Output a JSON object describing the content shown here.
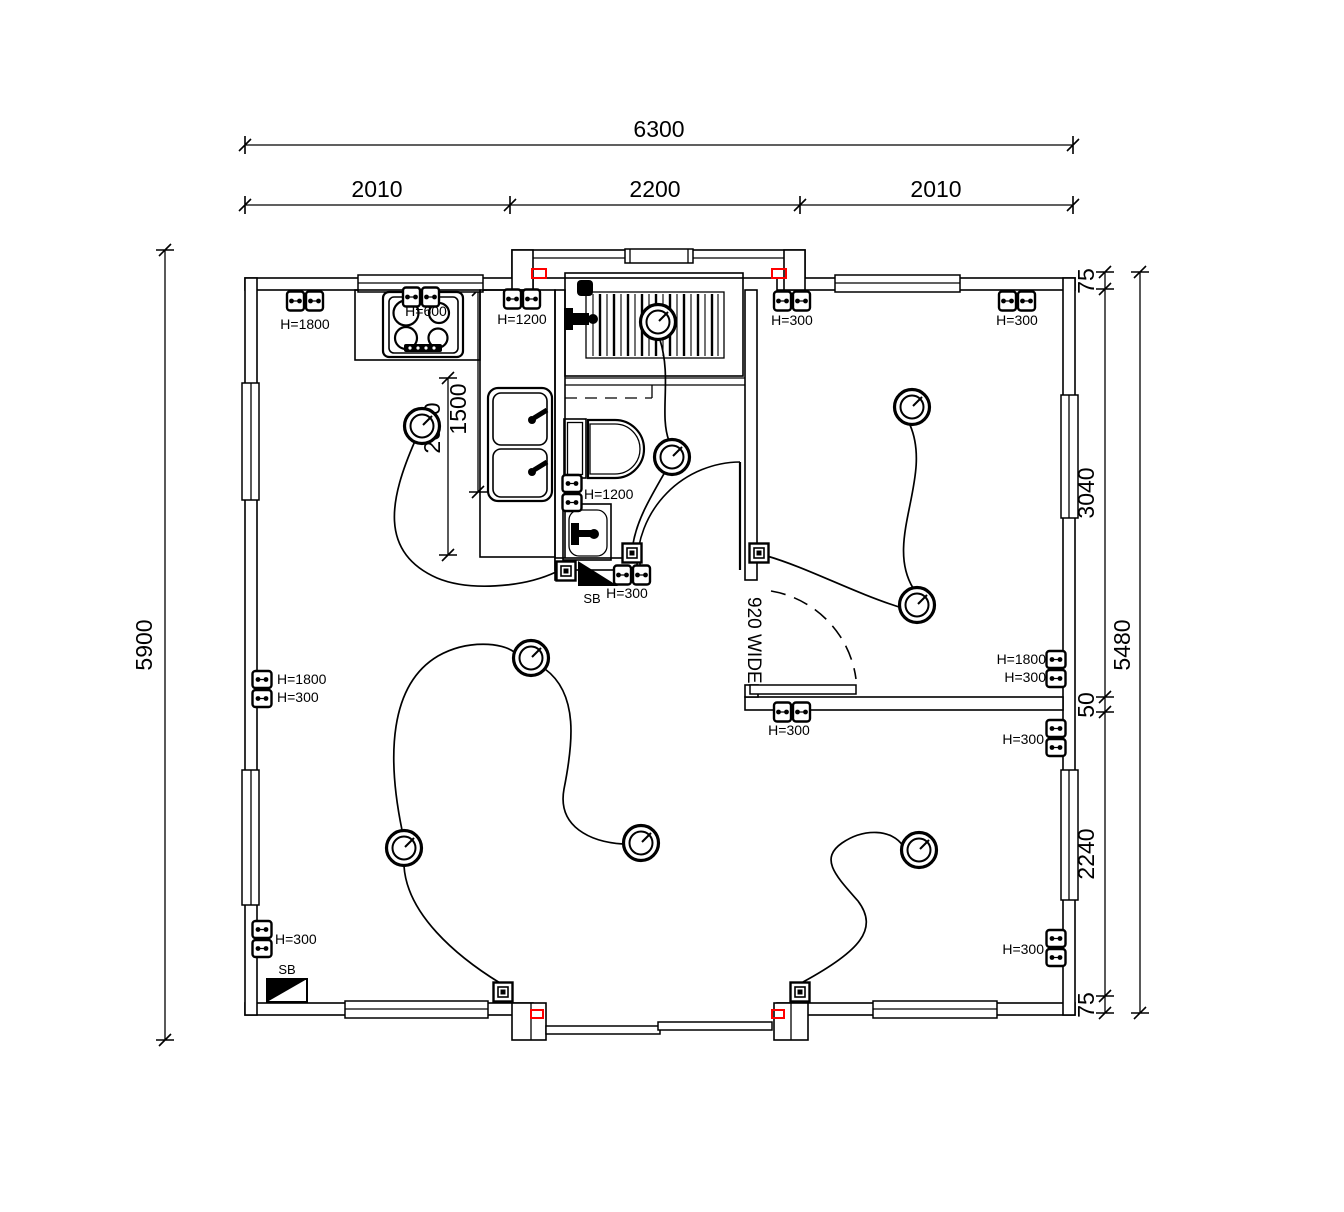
{
  "drawing": {
    "kind": "electrical floor plan",
    "background_color": "#ffffff",
    "line_color": "#000000",
    "accent_color": "#ff0000"
  },
  "dims": {
    "top_total": "6300",
    "top_seg_1": "2010",
    "top_seg_2": "2200",
    "top_seg_3": "2010",
    "left_total": "5900",
    "right_outer": "5480",
    "right_seg_1": "75",
    "right_seg_2": "3040",
    "right_seg_3": "50",
    "right_seg_4": "2240",
    "right_seg_5": "75",
    "kitchen_dim_1": "1500",
    "kitchen_dim_2": "2000",
    "door_width": "920 WIDE"
  },
  "electrical": {
    "outlets": [
      {
        "orient": "h",
        "x": 305,
        "y": 301,
        "labels": [
          {
            "text": "H=1800",
            "x": 305,
            "y": 329,
            "anchor": "middle"
          }
        ]
      },
      {
        "orient": "h",
        "x": 421,
        "y": 297,
        "labels": [
          {
            "text": "H=600",
            "x": 426,
            "y": 316,
            "anchor": "middle"
          }
        ]
      },
      {
        "orient": "h",
        "x": 522,
        "y": 299,
        "labels": [
          {
            "text": "H=1200",
            "x": 522,
            "y": 324,
            "anchor": "middle"
          }
        ]
      },
      {
        "orient": "h",
        "x": 792,
        "y": 301,
        "labels": [
          {
            "text": "H=300",
            "x": 792,
            "y": 325,
            "anchor": "middle"
          }
        ]
      },
      {
        "orient": "h",
        "x": 1017,
        "y": 301,
        "labels": [
          {
            "text": "H=300",
            "x": 1017,
            "y": 325,
            "anchor": "middle"
          }
        ]
      },
      {
        "orient": "v",
        "x": 262,
        "y": 689,
        "labels": [
          {
            "text": "H=1800",
            "x": 277,
            "y": 684,
            "anchor": "start"
          },
          {
            "text": "H=300",
            "x": 277,
            "y": 702,
            "anchor": "start"
          }
        ]
      },
      {
        "orient": "v",
        "x": 262,
        "y": 939,
        "labels": [
          {
            "text": "H=300",
            "x": 275,
            "y": 944,
            "anchor": "start"
          }
        ]
      },
      {
        "orient": "v",
        "x": 572,
        "y": 493,
        "labels": [
          {
            "text": "H=1200",
            "x": 584,
            "y": 499,
            "anchor": "start"
          }
        ]
      },
      {
        "orient": "h",
        "x": 632,
        "y": 575,
        "labels": [
          {
            "text": "H=300",
            "x": 627,
            "y": 598,
            "anchor": "middle"
          }
        ]
      },
      {
        "orient": "h",
        "x": 792,
        "y": 712,
        "labels": [
          {
            "text": "H=300",
            "x": 789,
            "y": 735,
            "anchor": "middle"
          }
        ]
      },
      {
        "orient": "v",
        "x": 1056,
        "y": 669,
        "labels": [
          {
            "text": "H=1800",
            "x": 1046,
            "y": 664,
            "anchor": "end"
          },
          {
            "text": "H=300",
            "x": 1046,
            "y": 682,
            "anchor": "end"
          }
        ]
      },
      {
        "orient": "v",
        "x": 1056,
        "y": 738,
        "labels": [
          {
            "text": "H=300",
            "x": 1044,
            "y": 744,
            "anchor": "end"
          }
        ]
      },
      {
        "orient": "v",
        "x": 1056,
        "y": 948,
        "labels": [
          {
            "text": "H=300",
            "x": 1044,
            "y": 954,
            "anchor": "end"
          }
        ]
      }
    ],
    "switches": [
      {
        "room": "kitchen",
        "x": 566,
        "y": 571
      },
      {
        "room": "bathroom",
        "x": 632,
        "y": 553
      },
      {
        "room": "bedroom-1",
        "x": 759,
        "y": 553
      },
      {
        "room": "living-left",
        "x": 503,
        "y": 992
      },
      {
        "room": "living-right",
        "x": 800,
        "y": 992
      }
    ],
    "lights": [
      {
        "room": "kitchen",
        "x": 422,
        "y": 426
      },
      {
        "room": "shower",
        "x": 658,
        "y": 322
      },
      {
        "room": "bathroom",
        "x": 672,
        "y": 457
      },
      {
        "room": "bedroom-1-a",
        "x": 912,
        "y": 407
      },
      {
        "room": "bedroom-1-b",
        "x": 917,
        "y": 605
      },
      {
        "room": "living-top",
        "x": 531,
        "y": 658
      },
      {
        "room": "living-left",
        "x": 404,
        "y": 848
      },
      {
        "room": "living-right",
        "x": 641,
        "y": 843
      },
      {
        "room": "bedroom-2",
        "x": 919,
        "y": 850
      }
    ],
    "boards": [
      {
        "label": "SB",
        "location": "bathroom-wall"
      },
      {
        "label": "SB",
        "location": "bottom-left-corner"
      }
    ]
  }
}
